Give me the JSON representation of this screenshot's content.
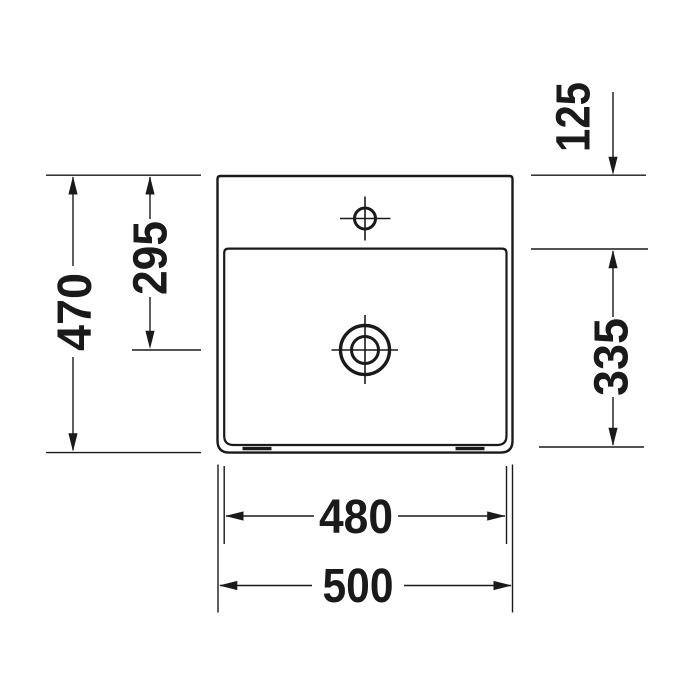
{
  "drawing": {
    "kind": "washbasin plan view technical drawing",
    "background": "#ffffff",
    "line_color": "#1a1a1a",
    "labels": {
      "overall_depth": "470",
      "rear_to_drain_center": "295",
      "tap_deck_depth": "125",
      "basin_inner_depth": "335",
      "basin_inner_width": "480",
      "overall_width": "500"
    }
  }
}
